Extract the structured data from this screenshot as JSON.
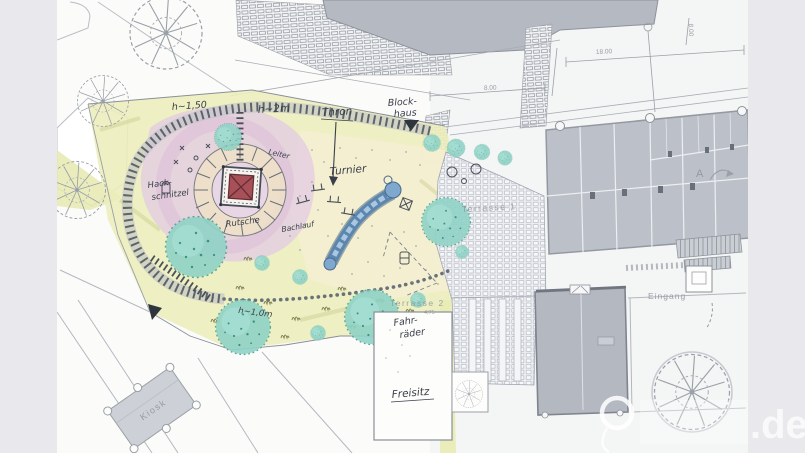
{
  "document": {
    "type": "scanned landscape / playground site plan (hand-coloured architectural drawing)",
    "watermark": ".de"
  },
  "plan_labels": {
    "h150": "h~1,50",
    "h2m": "h~2m",
    "h10m": "h~1,0m",
    "thron": "Thron",
    "block1": "Block-",
    "block2": "haus",
    "leiter": "Leiter",
    "hack1": "Hack-",
    "hack2": "schnitzel",
    "rutsche": "Rutsche",
    "bachlauf": "Bachlauf",
    "turnier": "Turnier",
    "terrasse1": "Terrasse 1",
    "terrasse2": "Terrasse 2",
    "level475": "4,75",
    "fahr1": "Fahr-",
    "fahr2": "räder",
    "freisitz": "Freisitz",
    "eingang": "Eingang",
    "kiosk": "Kiosk",
    "marker_a": "A"
  },
  "dimensions": {
    "dim_18": "18.00",
    "dim_8a": "8.00",
    "dim_8b": "8.00"
  },
  "watermark": {
    "suffix": ".de"
  },
  "colors": {
    "paper": "#fbfbf9",
    "side_band": "#e9e9ed",
    "ink": "#3a404a",
    "plan_gray": "#8d929b",
    "building_fill": "#b7bbc4",
    "playground_yellow": "#ecedbb",
    "mound_pink": "#e4cfe0",
    "tower_red": "#a84f58",
    "water_blue": "#5d86ad",
    "tree_teal": "#8fd2c5",
    "paving": "#edeef1",
    "watermark_white": "#fafafb"
  }
}
